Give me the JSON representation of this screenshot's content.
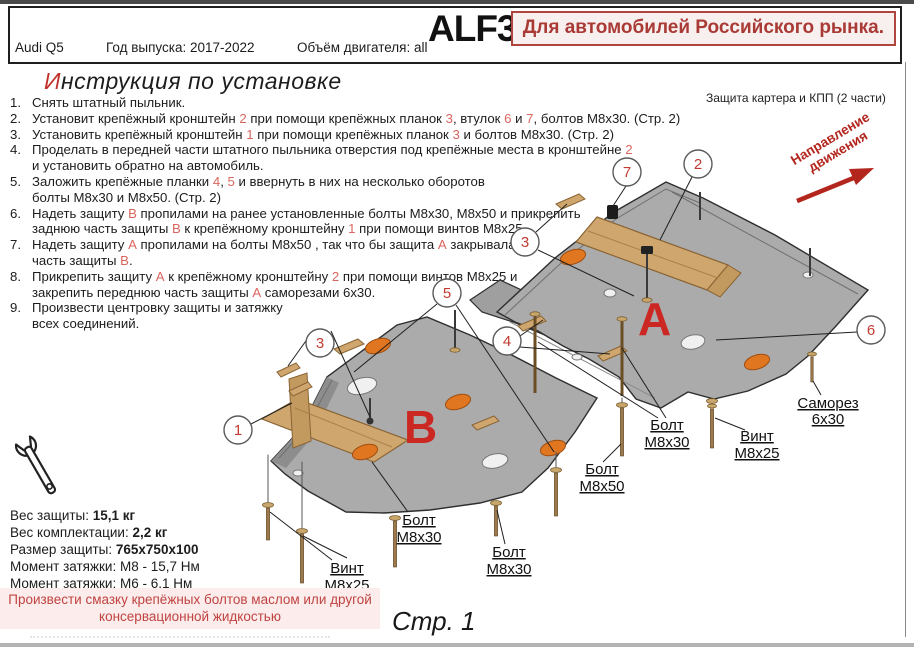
{
  "header": {
    "part_number": "ALF3044st",
    "market_note": "Для автомобилей Российского рынка.",
    "model": "Audi Q5",
    "year_label": "Год выпуска: 2017-2022",
    "engine_label": "Объём двигателя: all"
  },
  "instructions": {
    "title_first_letter": "И",
    "title_rest": "нструкция по установке",
    "items": [
      {
        "num": "1.",
        "segments": [
          {
            "t": "Снять штатный пыльник."
          }
        ]
      },
      {
        "num": "2.",
        "segments": [
          {
            "t": "Установит крепёжный кронштейн "
          },
          {
            "t": "2",
            "red": true
          },
          {
            "t": " при помощи крепёжных планок "
          },
          {
            "t": "3",
            "red": true
          },
          {
            "t": ", втулок "
          },
          {
            "t": "6",
            "red": true
          },
          {
            "t": " и "
          },
          {
            "t": "7",
            "red": true
          },
          {
            "t": ", болтов М8х30. (Стр. 2)"
          }
        ]
      },
      {
        "num": "3.",
        "segments": [
          {
            "t": "Установить крепёжный кронштейн "
          },
          {
            "t": "1",
            "red": true
          },
          {
            "t": " при помощи крепёжных планок "
          },
          {
            "t": "3",
            "red": true
          },
          {
            "t": " и болтов М8х30. (Стр. 2)"
          }
        ]
      },
      {
        "num": "4.",
        "segments": [
          {
            "t": "Проделать в передней части штатного пыльника отверстия под крепёжные места в кронштейне "
          },
          {
            "t": "2",
            "red": true
          },
          {
            "br": true
          },
          {
            "t": "и установить обратно на автомобиль."
          }
        ]
      },
      {
        "num": "5.",
        "segments": [
          {
            "t": "Заложить крепёжные планки "
          },
          {
            "t": "4",
            "red": true
          },
          {
            "t": ", "
          },
          {
            "t": "5",
            "red": true
          },
          {
            "t": " и ввернуть в них на несколько оборотов"
          },
          {
            "br": true
          },
          {
            "t": "болты М8х30 и М8х50. (Стр. 2)"
          }
        ]
      },
      {
        "num": "6.",
        "segments": [
          {
            "t": "Надеть защиту "
          },
          {
            "t": "В",
            "red": true
          },
          {
            "t": " пропилами на ранее установленные болты М8х30, М8х50 и прикрепить"
          },
          {
            "br": true
          },
          {
            "t": "заднюю часть защиты "
          },
          {
            "t": "В",
            "red": true
          },
          {
            "t": " к крепёжному кронштейну "
          },
          {
            "t": "1",
            "red": true
          },
          {
            "t": " при помощи винтов М8х25."
          }
        ]
      },
      {
        "num": "7.",
        "segments": [
          {
            "t": "Надеть защиту "
          },
          {
            "t": "А",
            "red": true
          },
          {
            "t": " пропилами на болты М8х50 , так что бы защита "
          },
          {
            "t": "А",
            "red": true
          },
          {
            "t": " закрывала"
          },
          {
            "br": true
          },
          {
            "t": "часть защиты "
          },
          {
            "t": "В",
            "red": true
          },
          {
            "t": "."
          }
        ]
      },
      {
        "num": "8.",
        "segments": [
          {
            "t": "Прикрепить защиту "
          },
          {
            "t": "А",
            "red": true
          },
          {
            "t": " к крепёжному кронштейну "
          },
          {
            "t": "2",
            "red": true
          },
          {
            "t": " при помощи винтов М8х25 и"
          },
          {
            "br": true
          },
          {
            "t": "закрепить переднюю часть защиты "
          },
          {
            "t": "А",
            "red": true
          },
          {
            "t": " саморезами 6х30."
          }
        ]
      },
      {
        "num": "9.",
        "segments": [
          {
            "t": "Произвести центровку защиты и затяжку"
          },
          {
            "br": true
          },
          {
            "t": "всех соединений."
          }
        ]
      }
    ]
  },
  "diagram": {
    "caption": "Защита картера и КПП (2 части)",
    "direction_line1": "Направление",
    "direction_line2": "движения",
    "plate_a_letter": "А",
    "plate_b_letter": "В",
    "callouts": [
      {
        "num": "1"
      },
      {
        "num": "3"
      },
      {
        "num": "5"
      },
      {
        "num": "4"
      },
      {
        "num": "3"
      },
      {
        "num": "7"
      },
      {
        "num": "2"
      },
      {
        "num": "6"
      }
    ],
    "bolt_labels": [
      {
        "l1": "Винт",
        "l2": "М8х25"
      },
      {
        "l1": "Болт",
        "l2": "М8х30"
      },
      {
        "l1": "Болт",
        "l2": "М8х30"
      },
      {
        "l1": "Болт",
        "l2": "М8х50"
      },
      {
        "l1": "Болт",
        "l2": "М8х30"
      },
      {
        "l1": "Винт",
        "l2": "М8х25"
      },
      {
        "l1": "Саморез",
        "l2": "6х30"
      }
    ],
    "colors": {
      "plate_gray": "#ababab",
      "bracket_tan": "#cfa76e",
      "logo_orange": "#e0761f",
      "accent_red": "#cc2823",
      "reference_red": "#d9665e",
      "direction_red": "#b3261e",
      "market_red": "#a93a35",
      "warning_red": "#bf4340"
    }
  },
  "specs": {
    "lines": [
      {
        "label": "Вес защиты: ",
        "value": "15,1 кг"
      },
      {
        "label": "Вес комплектации: ",
        "value": "2,2 кг"
      },
      {
        "label": "Размер защиты: ",
        "value": "765х750х100"
      },
      {
        "label": "Момент затяжки: ",
        "value": "М8 - 15,7 Нм"
      },
      {
        "label": "Момент затяжки: ",
        "value": "М6 - 6,1 Нм"
      }
    ]
  },
  "warning": {
    "line1": "Произвести смазку крепёжных болтов маслом или другой",
    "line2": "консервационной жидкостью"
  },
  "footer": {
    "page_label": "Стр. 1"
  }
}
